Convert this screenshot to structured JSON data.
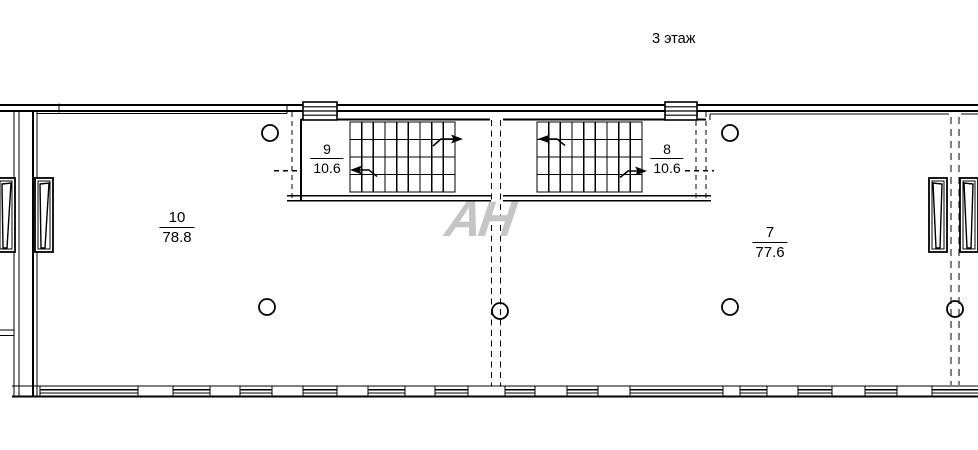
{
  "title": "3 этаж",
  "watermark": {
    "text": "АН",
    "color": "#c5c5c5"
  },
  "plan": {
    "background": "#ffffff",
    "line_color": "#000000",
    "rooms": [
      {
        "number": "10",
        "area": "78.8"
      },
      {
        "number": "7",
        "area": "77.6"
      }
    ],
    "stairwells": [
      {
        "number": "9",
        "area": "10.6"
      },
      {
        "number": "8",
        "area": "10.6"
      }
    ]
  }
}
